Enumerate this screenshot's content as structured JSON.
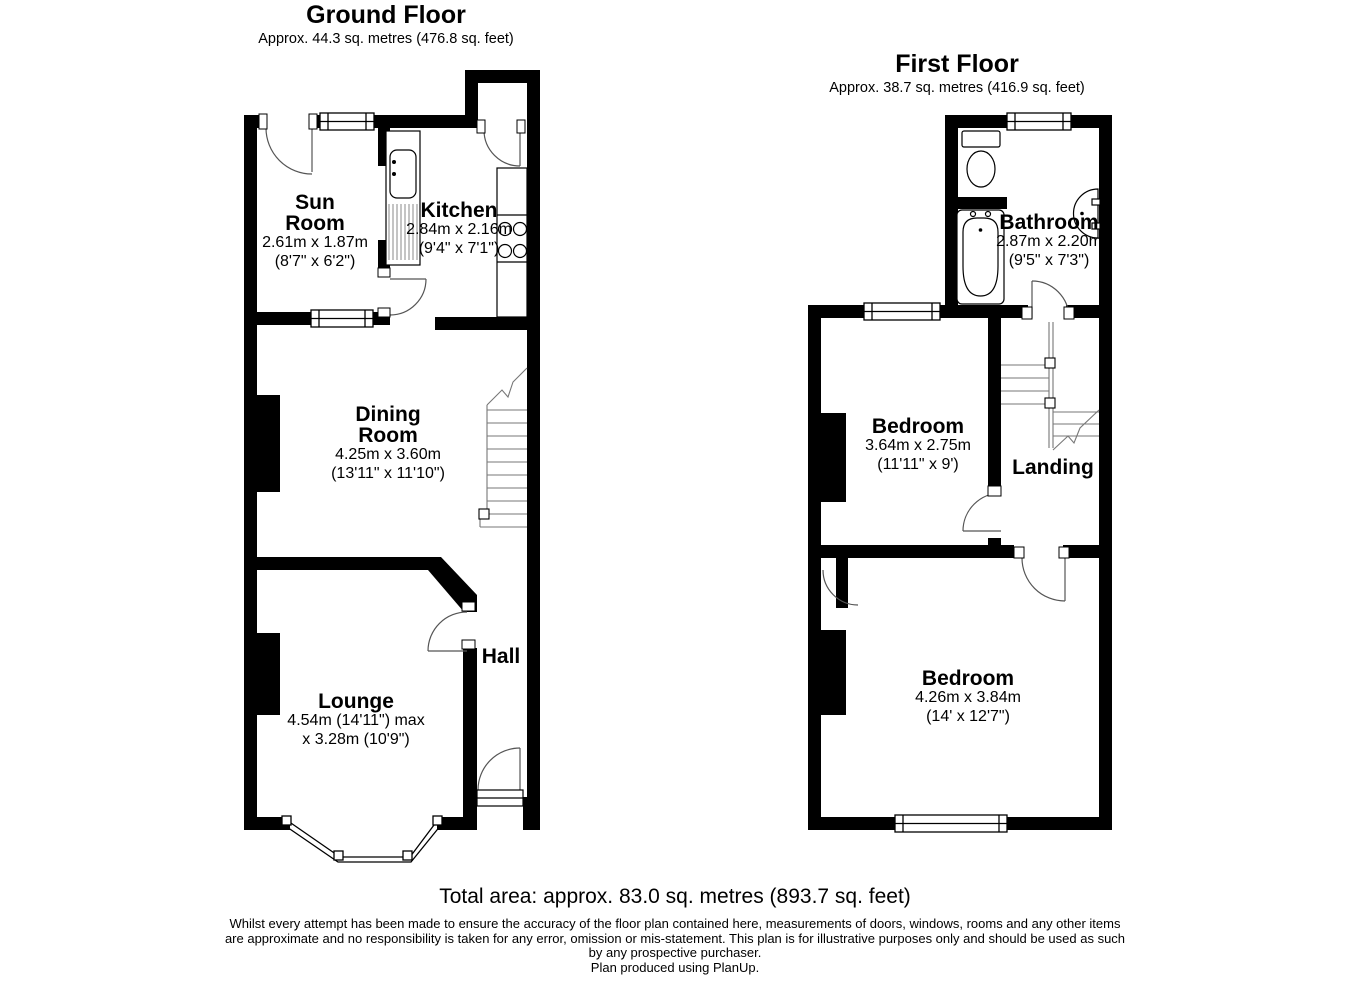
{
  "ground_floor": {
    "title": "Ground Floor",
    "subtitle": "Approx. 44.3 sq. metres (476.8 sq. feet)",
    "rooms": {
      "sun_room": {
        "line1": "Sun",
        "line2": "Room",
        "dims_m": "2.61m x 1.87m",
        "dims_i": "(8'7\" x 6'2\")"
      },
      "kitchen": {
        "line1": "Kitchen",
        "dims_m": "2.84m x 2.16m",
        "dims_i": "(9'4\" x 7'1\")"
      },
      "dining_room": {
        "line1": "Dining",
        "line2": "Room",
        "dims_m": "4.25m x 3.60m",
        "dims_i": "(13'11\" x 11'10\")"
      },
      "lounge": {
        "line1": "Lounge",
        "dims_m": "4.54m (14'11\") max",
        "dims_i": "x 3.28m (10'9\")"
      },
      "hall": {
        "line1": "Hall"
      }
    }
  },
  "first_floor": {
    "title": "First Floor",
    "subtitle": "Approx. 38.7 sq. metres (416.9 sq. feet)",
    "rooms": {
      "bathroom": {
        "line1": "Bathroom",
        "dims_m": "2.87m x 2.20m",
        "dims_i": "(9'5\" x 7'3\")"
      },
      "bedroom_front": {
        "line1": "Bedroom",
        "dims_m": "3.64m x 2.75m",
        "dims_i": "(11'11\" x 9')"
      },
      "landing": {
        "line1": "Landing"
      },
      "bedroom_back": {
        "line1": "Bedroom",
        "dims_m": "4.26m x 3.84m",
        "dims_i": "(14' x 12'7\")"
      }
    }
  },
  "footer": {
    "total_area": "Total area: approx. 83.0 sq. metres (893.7 sq. feet)",
    "disclaimer_l1": "Whilst every attempt has been made to ensure the accuracy of the floor plan contained here, measurements of doors, windows, rooms and any other items",
    "disclaimer_l2": "are approximate and no responsibility is taken for any error, omission or mis-statement. This plan is for illustrative purposes only and should be used as such",
    "disclaimer_l3": "by any prospective purchaser.",
    "credit": "Plan produced using PlanUp."
  },
  "colors": {
    "wall": "#000000",
    "background": "#ffffff",
    "detail_line": "#666666"
  }
}
